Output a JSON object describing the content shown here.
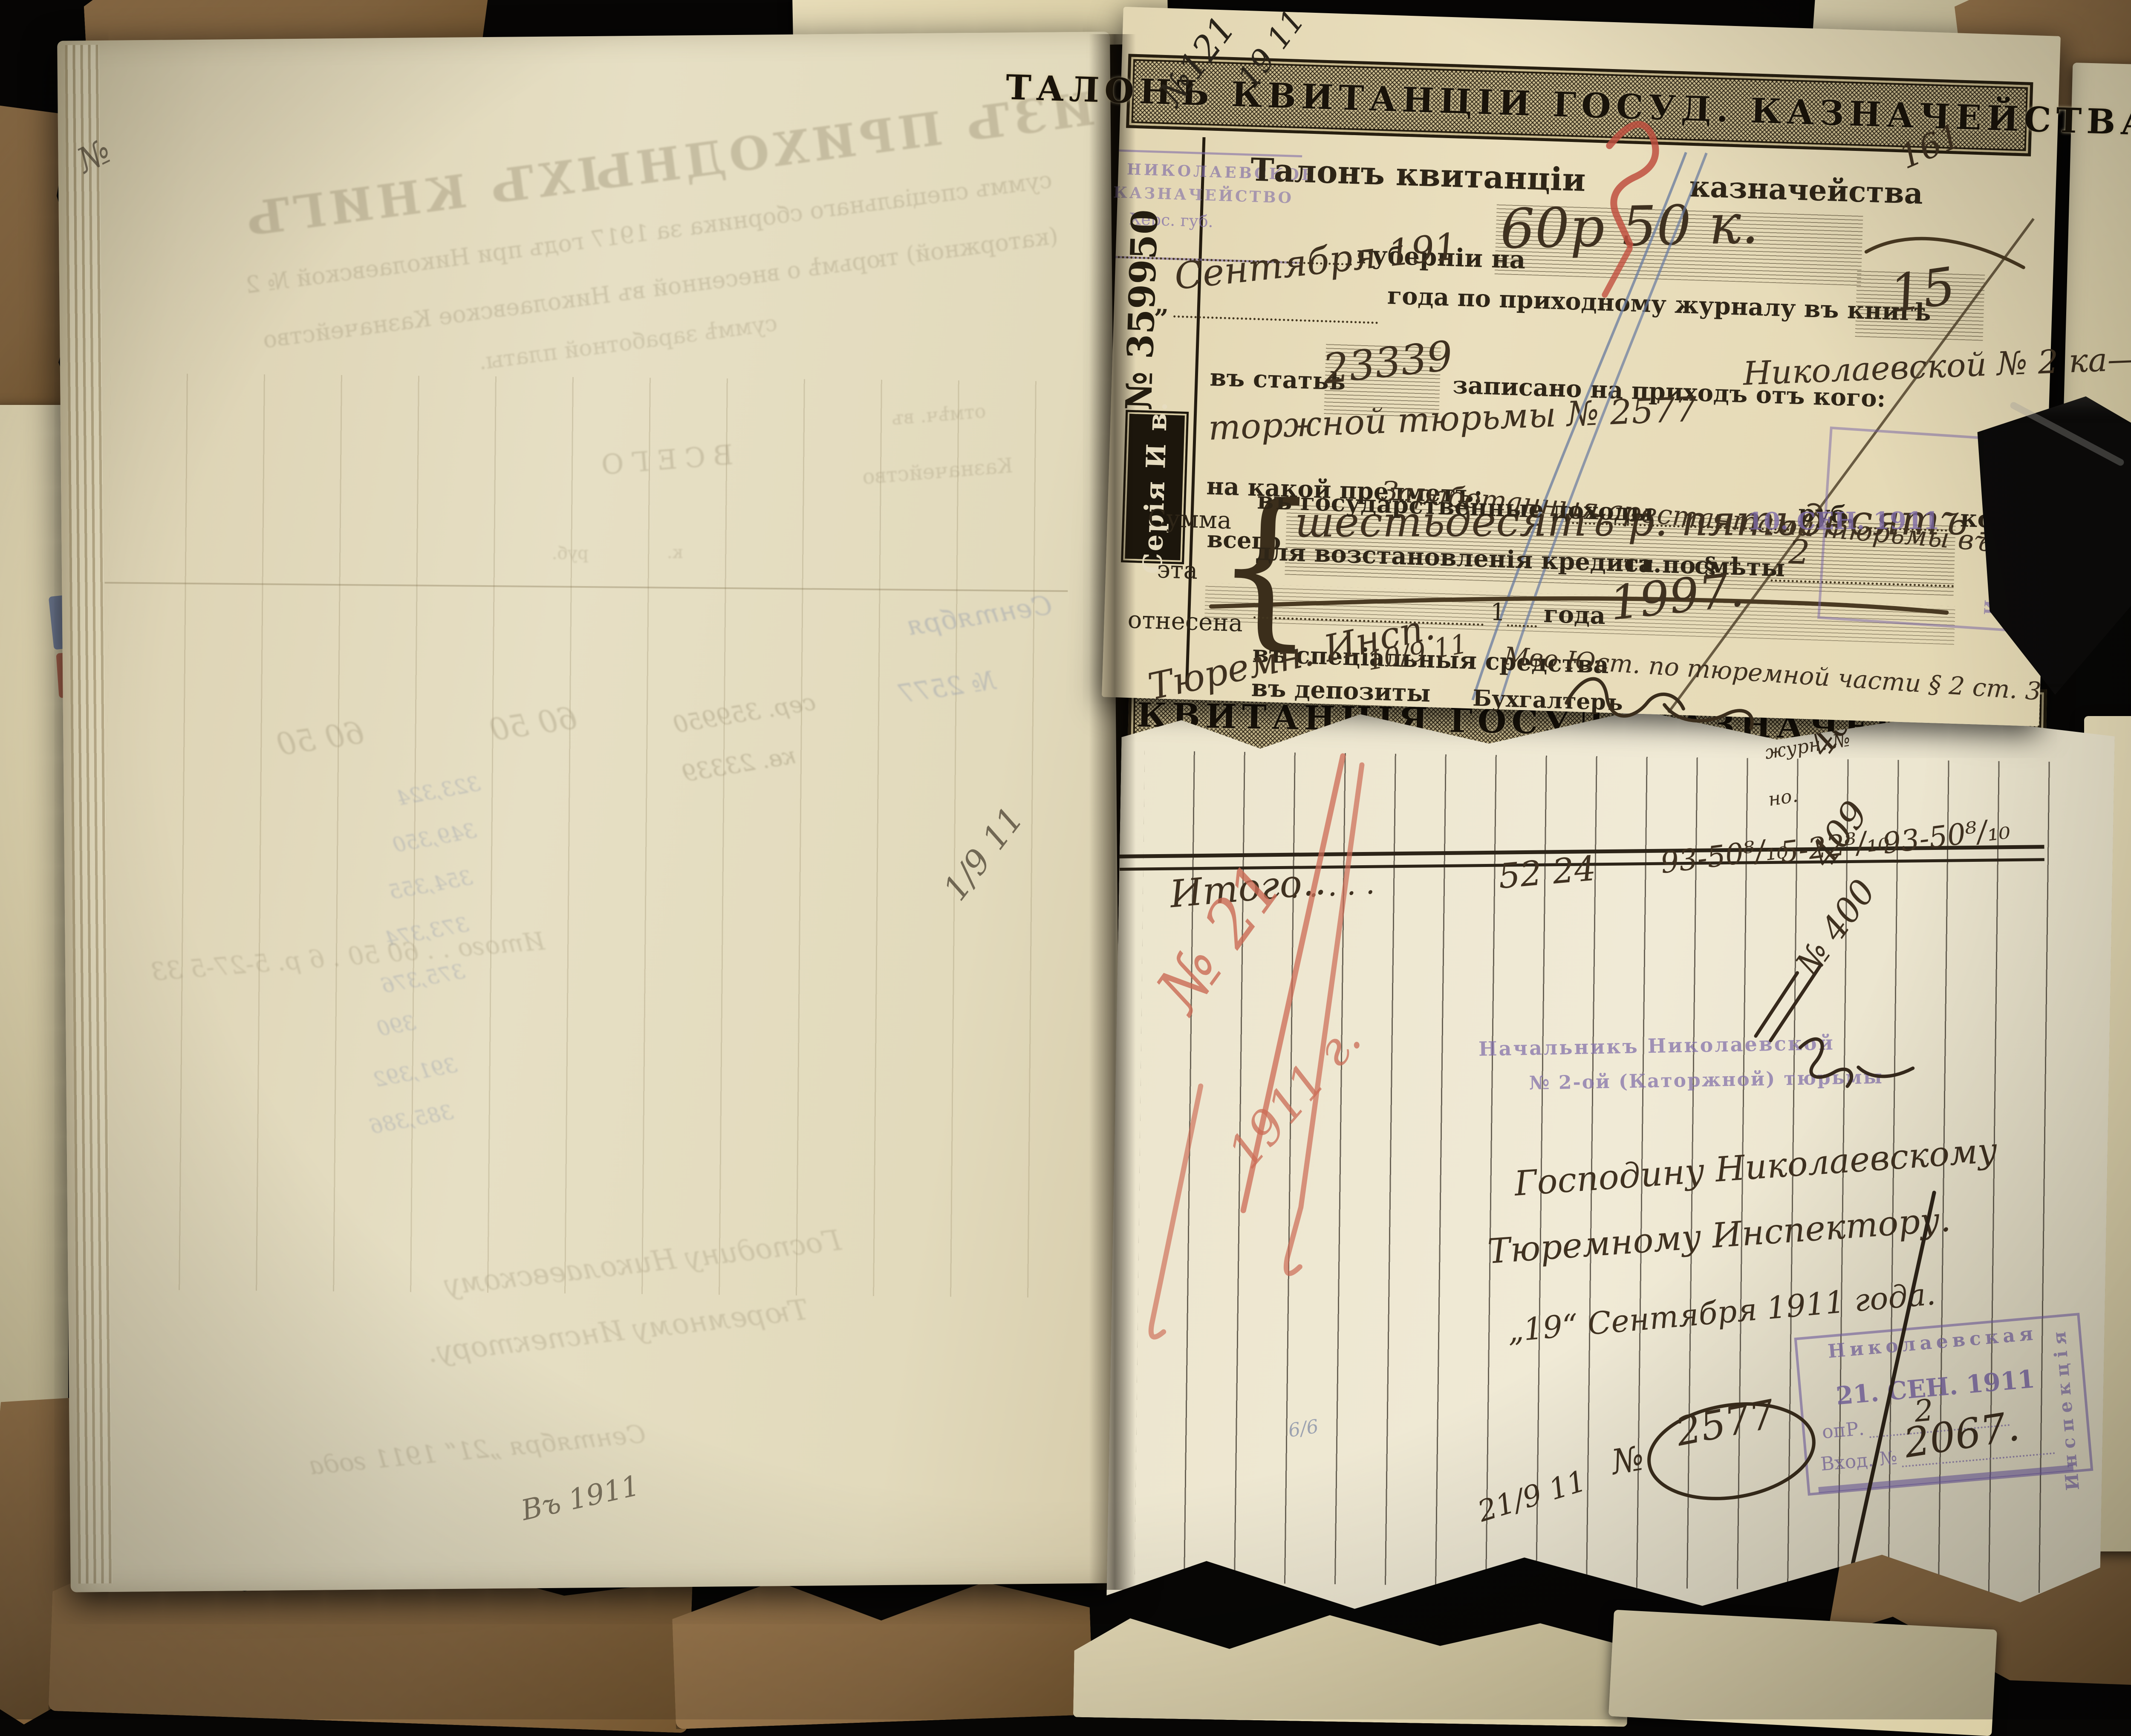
{
  "talon": {
    "band_title": "ТАЛОНЪ КВИТАНЦІИ ГОСУД. КАЗНАЧЕЙСТВА",
    "page_number": "161",
    "heading_left": "Талонъ квитанціи",
    "heading_right": "казначейства",
    "serial_number": "№ 359950",
    "series_plate": "Серія И в.",
    "treasury_stamp_line1": "НИКОЛАЕВСКОЕ",
    "treasury_stamp_line2": "КАЗНАЧЕЙСТВО",
    "treasury_stamp_line3": "Херс. губ.",
    "pencil_note": "№121",
    "pencil_note2": "19 11",
    "quote_mark": "„",
    "label_gubernii": "губерніи на",
    "amount_hand": "60р 50 к.",
    "month_hand": "Сентября 191",
    "label_journal": "года по приходному журналу въ книгѣ",
    "book_hand": "15",
    "label_article": "въ статьѣ",
    "article_hand": "23339",
    "label_recorded": "записано на приходъ отъ кого:",
    "payer_hand1": "Николаевской № 2 ка—",
    "payer_hand2": "торжной тюрьмы № 2577",
    "label_subject": "на какой предметъ:",
    "subject_hand": "Заработанныя арестантами тюрьмы въ 1911.",
    "label_total": "всего",
    "total_hand": "шестьдесятъ р. пятьдесятъ К.",
    "sum_word1": "Сумма",
    "sum_word2": "эта",
    "sum_word3": "отнесена",
    "brace": "{",
    "row_state": "въ государственные доходы",
    "unit_rub": "руб.",
    "unit_kop": "коп.",
    "row_credit": "для возстановленія кредита по §",
    "label_st": "ст.",
    "label_smety": "смѣты",
    "one": "1",
    "label_year": "года",
    "smeta_hand": "1997.",
    "row_special": "въ спеціальныя средства",
    "special_hand": "Мво Юст. по тюремной части § 2 ст. 3",
    "row_deposit": "въ депозиты",
    "footer_hand": "Тюремн. Инсп.",
    "footer_date": "10/9 11",
    "label_accountant": "Бухгалтеръ",
    "date_stamp": "10. СЕН. 1911",
    "date_stamp_hand": "2",
    "inspection_vertical": "Инспекція"
  },
  "receipt": {
    "band_title": "КВИТАНЦІЯ ГОСУД. КАЗНАЧЕЙСТВА",
    "journal_hand": "журн. №",
    "journal_hand2": "но.",
    "num1": "408",
    "num2": "409",
    "num3": "№ 400",
    "itogo_label": "Итого..",
    "itogo_dots": ".     .     .     .     .",
    "itogo_v1": "52 24",
    "itogo_v2": "93-50⁸/₁₀",
    "itogo_v3": "5-22⁸/₁₀",
    "itogo_v4": "93-50⁸/₁₀",
    "red_note1": "№ 21",
    "red_note2": "1911 г.",
    "warden_stamp1": "Начальникъ Николаевской",
    "warden_stamp2": "№ 2-ой (Каторжной) тюрьмы",
    "address1": "Господину Николаевскому",
    "address2": "Тюремному Инспектору.",
    "date_line": "„19“ Сентября 1911 года.",
    "no_label": "№",
    "no_value": "2577",
    "stamp_box_line1": "Николаевская",
    "stamp_box_date": "21. СЕН. 1911",
    "stamp_box_opr": "опР.",
    "stamp_box_vhod": "Вход. №",
    "stamp_box_hand1": "2",
    "stamp_box_hand2": "2067.",
    "stamp_box_vertical": "Инспекція",
    "bottom_date_hand": "21/9 11",
    "blue_mark": "6/6"
  },
  "left_page": {
    "mirror_title": "ВЫПИСКА ИЗЪ ПРИХОДНЫХЪ КНИГЪ",
    "mirror_sub1": "суммъ спеціальнаго сборника за 1917 годъ при Николаевской № 2",
    "mirror_sub2": "(каторжной) тюрьмѣ о внесенной въ Николаевское Казначейство",
    "mirror_sub3": "суммѣ заработной платы.",
    "mirror_vsego": "ВСЕГО",
    "mirror_rub": "руб.",
    "mirror_kop": "к.",
    "mirror_header1": "отмѣч. въ",
    "mirror_header2": "Казначейство",
    "mirror_hand1": "Сентября",
    "mirror_hand2": "№ 2577",
    "mirror_hand3": "сер. 359950",
    "mirror_hand4": "кв. 23339",
    "mirror_hand5": "60 50",
    "mirror_hand6": "60 50",
    "mirror_numbers": [
      "323,324",
      "349,350",
      "354,355",
      "373,374",
      "375,376",
      "390",
      "391,392",
      "385,386"
    ],
    "mirror_itogo": "Итого . .  60 50  .  6 р. 5-27-5 33",
    "mirror_addr1": "Господину Николаевскому",
    "mirror_addr2": "Тюремному Инспектору.",
    "mirror_date": "Сентября „21“ 1911 года",
    "pencil_mark": "1/9 11",
    "pencil_bottom": "Въ 1911",
    "pencil_top": "№"
  }
}
